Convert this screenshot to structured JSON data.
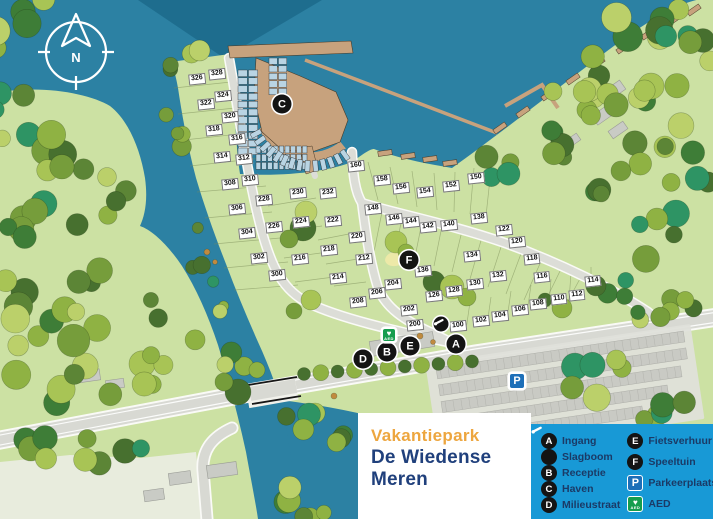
{
  "title": {
    "line1": "Vakantiepark",
    "line2": "De Wiedense Meren"
  },
  "compass": {
    "label": "N"
  },
  "colors": {
    "water": "#2C81A3",
    "water_deep": "#1E6D8E",
    "land": "#CCE1A3",
    "legend_blue": "#1899D6",
    "legend_text": "#1B3A66",
    "title_orange": "#EDA63F",
    "title_navy": "#20407C",
    "marker_black": "#141414",
    "parking_blue": "#1D6FB8",
    "aed_green": "#169D4E",
    "dock_tan": "#C7A27D",
    "slip_blue": "#B9D4E3"
  },
  "legend": {
    "columns": [
      [
        {
          "icon": "A",
          "label": "Ingang"
        },
        {
          "icon": "slagboom",
          "label": "Slagboom"
        },
        {
          "icon": "B",
          "label": "Receptie"
        },
        {
          "icon": "C",
          "label": "Haven"
        },
        {
          "icon": "D",
          "label": "Milieustraat"
        }
      ],
      [
        {
          "icon": "E",
          "label": "Fietsverhuur"
        },
        {
          "icon": "F",
          "label": "Speeltuin"
        },
        {
          "icon": "P",
          "label": "Parkeerplaats"
        },
        {
          "icon": "AED",
          "label": "AED"
        }
      ]
    ]
  },
  "map": {
    "markers": [
      {
        "id": "A",
        "x": 456,
        "y": 344
      },
      {
        "id": "B",
        "x": 387,
        "y": 352
      },
      {
        "id": "C",
        "x": 282,
        "y": 104
      },
      {
        "id": "D",
        "x": 363,
        "y": 359
      },
      {
        "id": "E",
        "x": 410,
        "y": 346
      },
      {
        "id": "F",
        "x": 409,
        "y": 260
      },
      {
        "id": "slagboom",
        "x": 441,
        "y": 324
      },
      {
        "id": "P",
        "x": 517,
        "y": 381
      },
      {
        "id": "AED",
        "x": 389,
        "y": 335
      }
    ],
    "plots": [
      {
        "n": "100",
        "x": 458,
        "y": 326
      },
      {
        "n": "102",
        "x": 481,
        "y": 321
      },
      {
        "n": "104",
        "x": 500,
        "y": 316
      },
      {
        "n": "106",
        "x": 520,
        "y": 310
      },
      {
        "n": "108",
        "x": 538,
        "y": 304
      },
      {
        "n": "110",
        "x": 559,
        "y": 299
      },
      {
        "n": "112",
        "x": 577,
        "y": 295
      },
      {
        "n": "114",
        "x": 593,
        "y": 281
      },
      {
        "n": "116",
        "x": 542,
        "y": 277
      },
      {
        "n": "118",
        "x": 532,
        "y": 259
      },
      {
        "n": "120",
        "x": 517,
        "y": 242
      },
      {
        "n": "122",
        "x": 504,
        "y": 230
      },
      {
        "n": "126",
        "x": 434,
        "y": 296
      },
      {
        "n": "128",
        "x": 454,
        "y": 291
      },
      {
        "n": "130",
        "x": 475,
        "y": 284
      },
      {
        "n": "132",
        "x": 498,
        "y": 276
      },
      {
        "n": "134",
        "x": 472,
        "y": 256
      },
      {
        "n": "136",
        "x": 423,
        "y": 271
      },
      {
        "n": "138",
        "x": 479,
        "y": 218
      },
      {
        "n": "140",
        "x": 449,
        "y": 225
      },
      {
        "n": "142",
        "x": 428,
        "y": 227
      },
      {
        "n": "144",
        "x": 411,
        "y": 222
      },
      {
        "n": "146",
        "x": 394,
        "y": 219
      },
      {
        "n": "148",
        "x": 373,
        "y": 209
      },
      {
        "n": "150",
        "x": 476,
        "y": 178
      },
      {
        "n": "152",
        "x": 451,
        "y": 186
      },
      {
        "n": "154",
        "x": 425,
        "y": 192
      },
      {
        "n": "156",
        "x": 401,
        "y": 188
      },
      {
        "n": "158",
        "x": 382,
        "y": 180
      },
      {
        "n": "160",
        "x": 356,
        "y": 166
      },
      {
        "n": "200",
        "x": 415,
        "y": 325
      },
      {
        "n": "202",
        "x": 409,
        "y": 310
      },
      {
        "n": "204",
        "x": 393,
        "y": 284
      },
      {
        "n": "206",
        "x": 377,
        "y": 293
      },
      {
        "n": "208",
        "x": 358,
        "y": 302
      },
      {
        "n": "212",
        "x": 364,
        "y": 259
      },
      {
        "n": "214",
        "x": 338,
        "y": 278
      },
      {
        "n": "216",
        "x": 300,
        "y": 259
      },
      {
        "n": "218",
        "x": 329,
        "y": 250
      },
      {
        "n": "220",
        "x": 357,
        "y": 237
      },
      {
        "n": "222",
        "x": 333,
        "y": 221
      },
      {
        "n": "224",
        "x": 301,
        "y": 222
      },
      {
        "n": "226",
        "x": 274,
        "y": 227
      },
      {
        "n": "228",
        "x": 264,
        "y": 200
      },
      {
        "n": "230",
        "x": 298,
        "y": 193
      },
      {
        "n": "232",
        "x": 328,
        "y": 193
      },
      {
        "n": "300",
        "x": 277,
        "y": 275
      },
      {
        "n": "302",
        "x": 259,
        "y": 258
      },
      {
        "n": "304",
        "x": 247,
        "y": 233
      },
      {
        "n": "306",
        "x": 237,
        "y": 209
      },
      {
        "n": "308",
        "x": 230,
        "y": 184
      },
      {
        "n": "310",
        "x": 250,
        "y": 180
      },
      {
        "n": "312",
        "x": 244,
        "y": 159
      },
      {
        "n": "314",
        "x": 222,
        "y": 157
      },
      {
        "n": "316",
        "x": 237,
        "y": 139
      },
      {
        "n": "318",
        "x": 214,
        "y": 130
      },
      {
        "n": "320",
        "x": 230,
        "y": 117
      },
      {
        "n": "322",
        "x": 206,
        "y": 104
      },
      {
        "n": "324",
        "x": 223,
        "y": 96
      },
      {
        "n": "326",
        "x": 197,
        "y": 79
      },
      {
        "n": "328",
        "x": 217,
        "y": 74
      }
    ]
  }
}
